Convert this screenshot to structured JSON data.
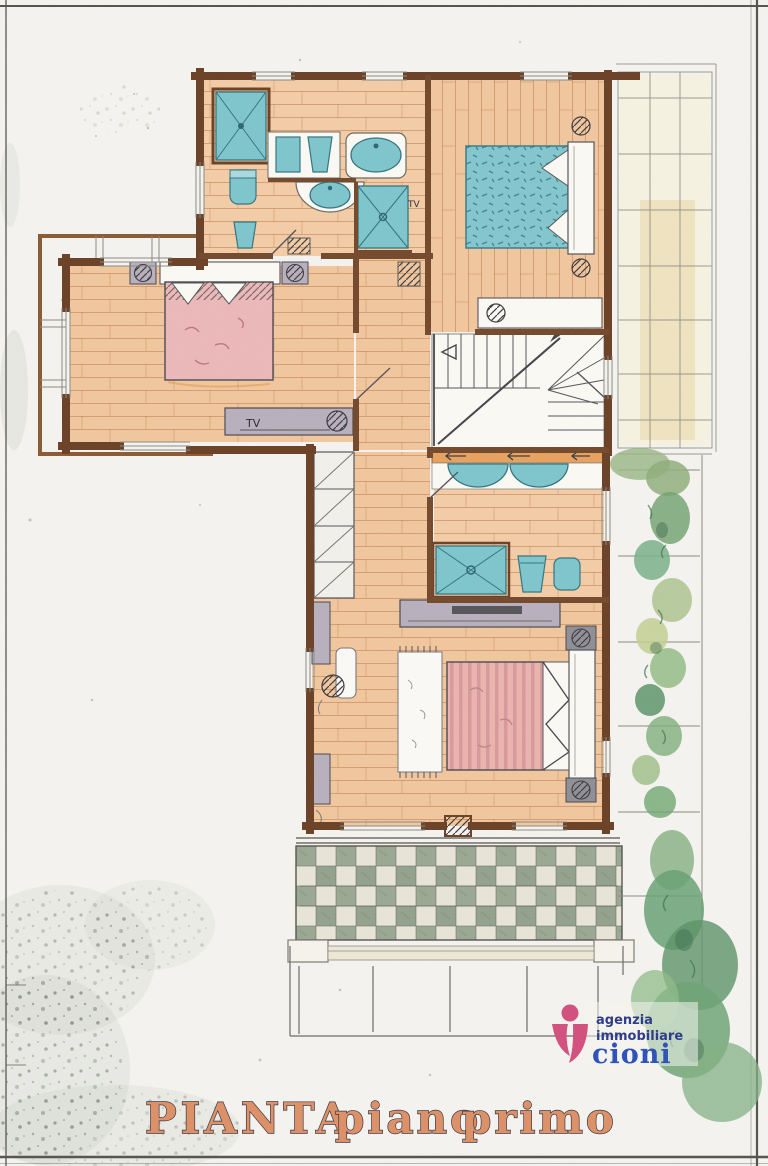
{
  "title": {
    "word1": "PIANTA",
    "word2": "piano",
    "word3": "primo"
  },
  "labels": {
    "tv_bathroom_wall": "TV",
    "tv_left_bedroom": "TV"
  },
  "logo": {
    "line1": "agenzia",
    "line2": "immobiliare",
    "name": "cioni"
  },
  "colors": {
    "wall": "#6b4126",
    "floor": "#f2c79e",
    "plank_line": "#bd7b4c",
    "fixture_teal": "#7ec6cd",
    "fixture_teal_dark": "#35747f",
    "bed_pink": "#ecb9b9",
    "bed_teal": "#84c7cf",
    "furniture_gray": "#b9b0bd",
    "terrace_check_green": "#9aa894",
    "terrace_check_light": "#e9e6d8",
    "vegetation_green": "#6fa576",
    "title_fill": "#dd9066",
    "title_outline": "#3a3440",
    "logo_pink": "#d34f7e",
    "logo_navy": "#2b3a88",
    "logo_blue": "#2b50b8",
    "ink": "#2b2b33"
  }
}
